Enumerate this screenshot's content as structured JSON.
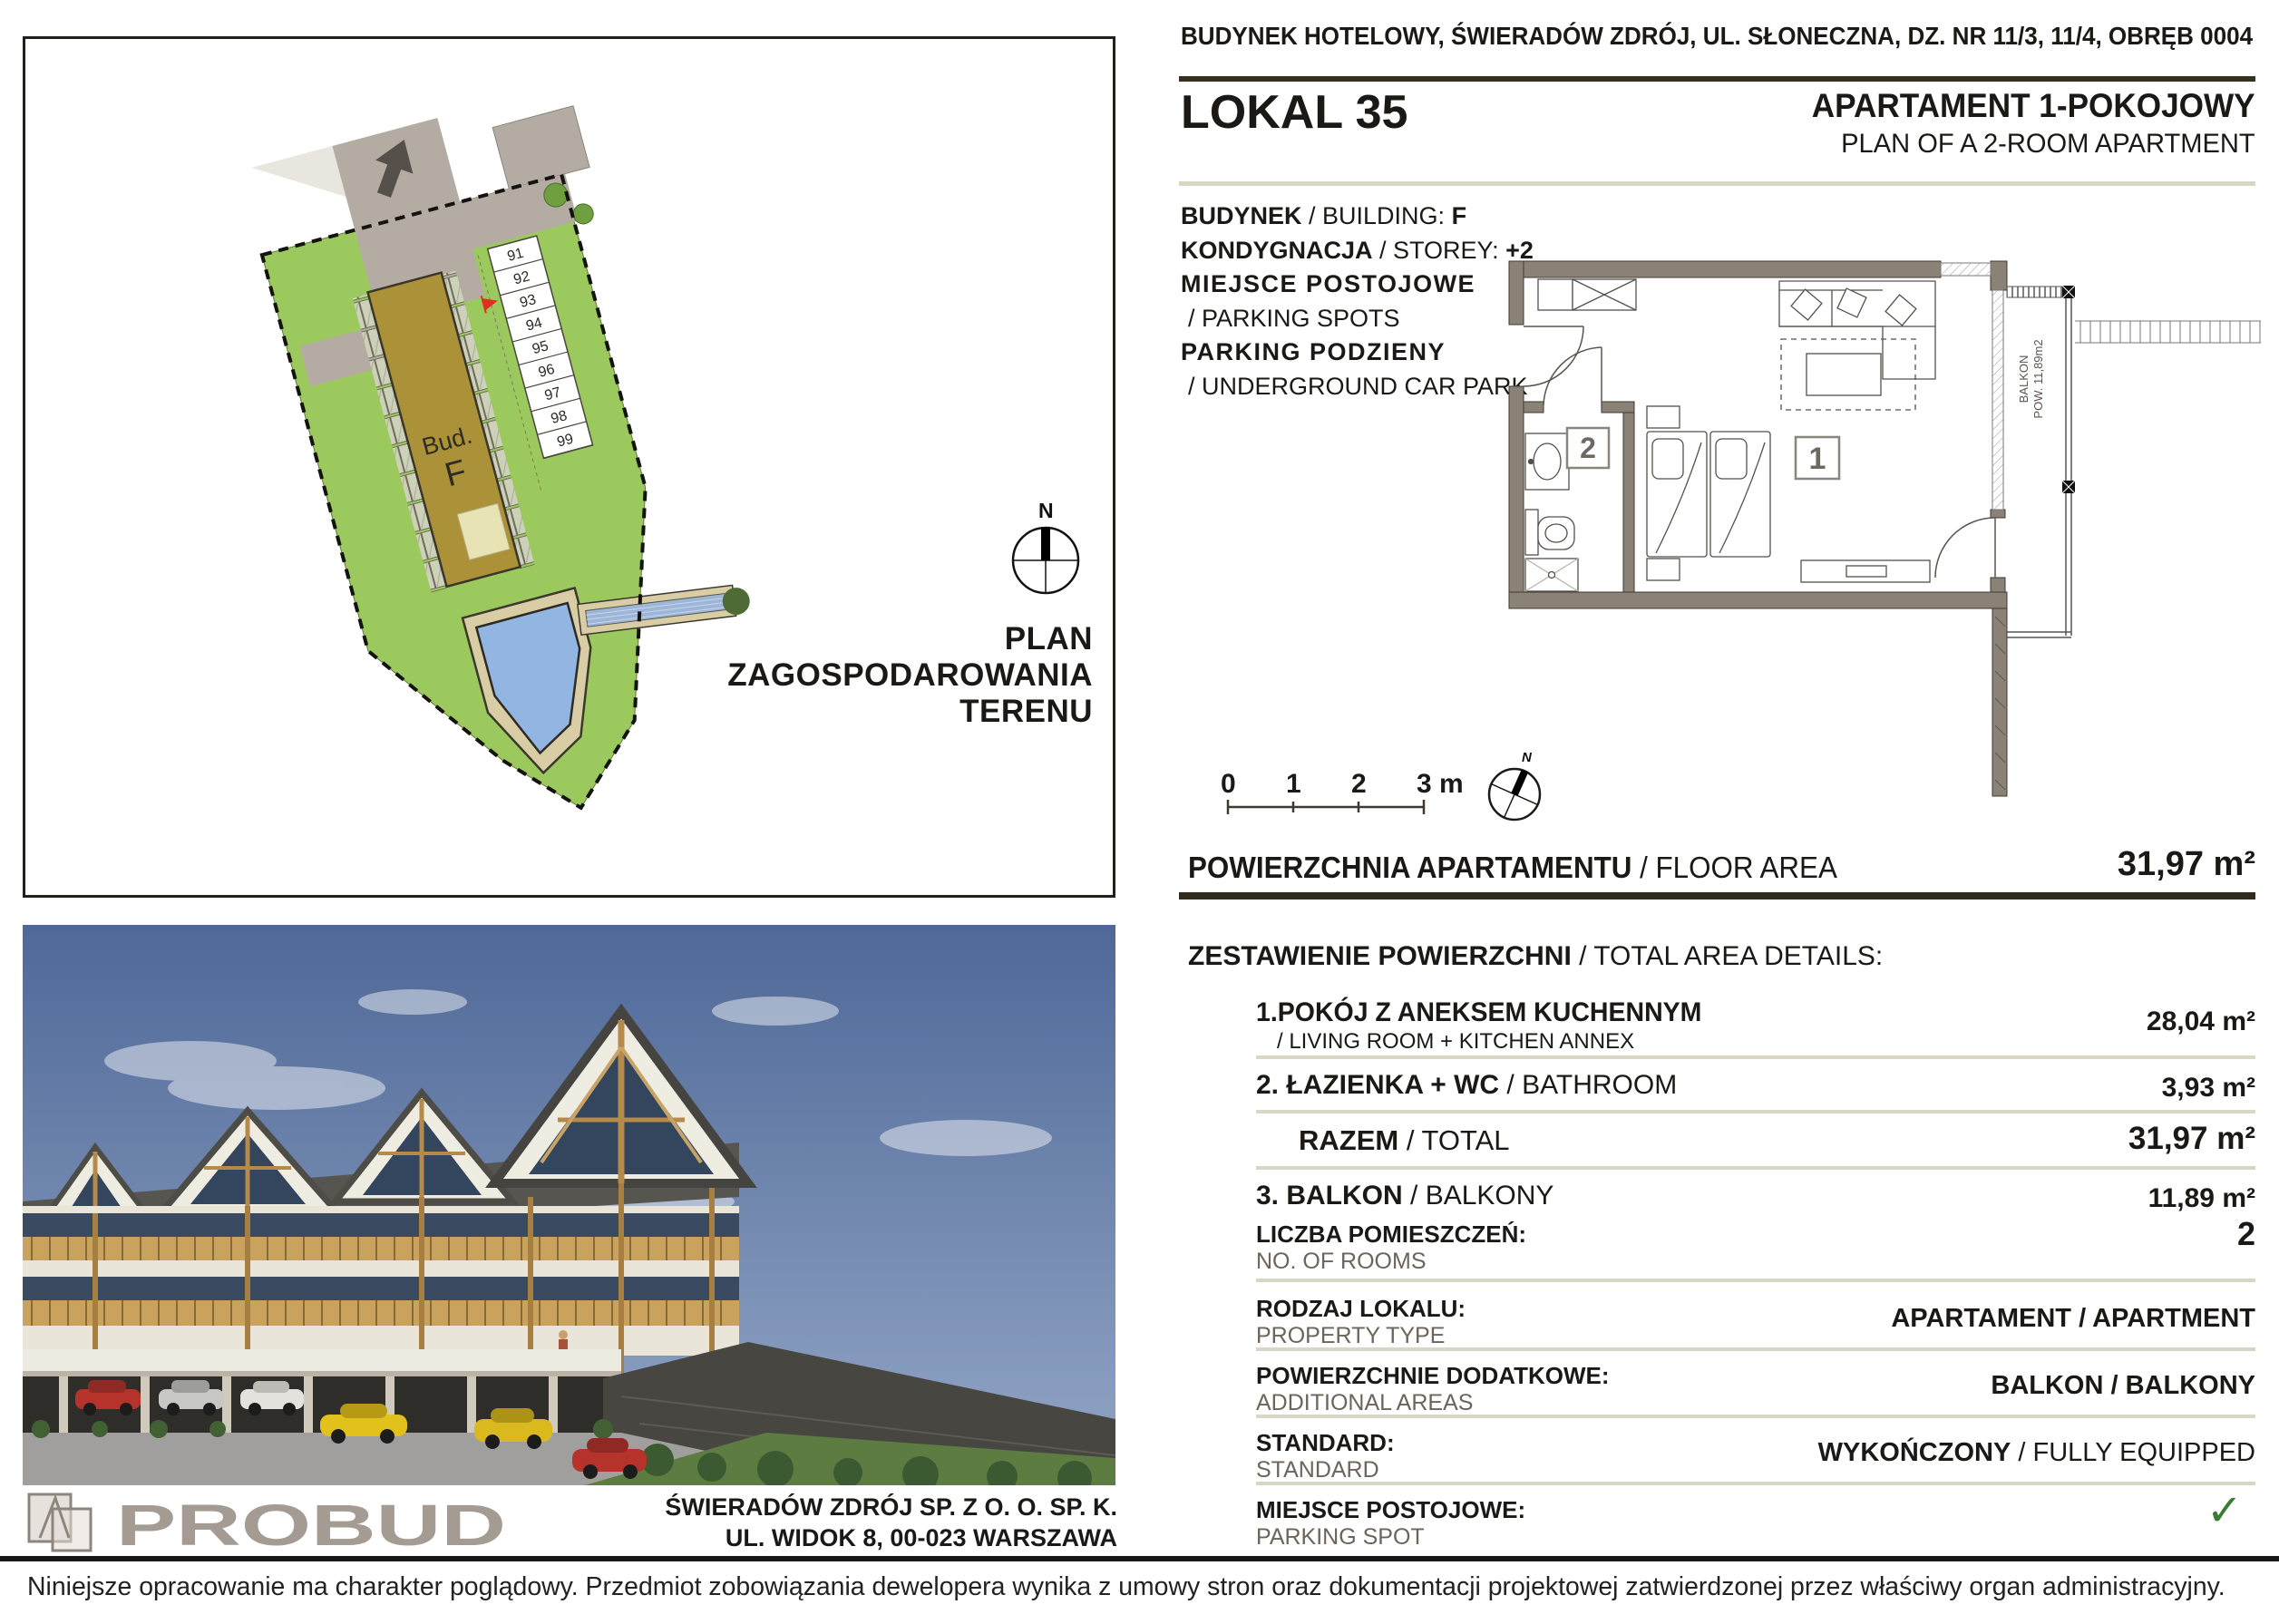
{
  "page": {
    "address_header": "BUDYNEK HOTELOWY, ŚWIERADÓW ZDRÓJ, UL. SŁONECZNA, DZ. NR 11/3, 11/4, OBRĘB 0004",
    "disclaimer": "Niniejsze opracowanie ma charakter poglądowy. Przedmiot zobowiązania dewelopera wynika z umowy stron oraz dokumentacji projektowej zatwierdzonej przez właściwy organ administracyjny."
  },
  "unit": {
    "lokal": "LOKAL 35",
    "type_pl": "APARTAMENT 1-POKOJOWY",
    "type_en": "PLAN OF A 2-ROOM APARTMENT",
    "building_label_pl": "BUDYNEK",
    "building_label_en": " / BUILDING: ",
    "building_value": "F",
    "storey_label_pl": "KONDYGNACJA",
    "storey_label_en": " / STOREY: ",
    "storey_value": "+2",
    "parking_pl": "MIEJSCE POSTOJOWE",
    "parking_en": "/ PARKING SPOTS",
    "garage_pl": "PARKING PODZIENY",
    "garage_en": "/ UNDERGROUND CAR PARK"
  },
  "site_plan": {
    "title_line1": "PLAN",
    "title_line2": "ZAGOSPODAROWANIA",
    "title_line3": "TERENU",
    "building_label_line1": "Bud.",
    "building_label_line2": "F",
    "compass_n": "N",
    "parking_numbers": [
      "91",
      "92",
      "93",
      "94",
      "95",
      "96",
      "97",
      "98",
      "99"
    ]
  },
  "floor_plan": {
    "room1": "1",
    "room2": "2",
    "balcony_line1": "BALKON",
    "balcony_line2": "POW. 11,89m2",
    "compass_n": "N",
    "scale_ticks": [
      "0",
      "1",
      "2",
      "3 m"
    ]
  },
  "area_summary": {
    "title_pl": "POWIERZCHNIA APARTAMENTU",
    "title_en": " / FLOOR AREA",
    "value": "31,97 m²",
    "details_title_pl": "ZESTAWIENIE POWIERZCHNI",
    "details_title_en": " / TOTAL AREA DETAILS:",
    "rows": [
      {
        "label_pl": "1.POKÓJ Z ANEKSEM KUCHENNYM",
        "label_en": "/ LIVING ROOM + KITCHEN ANNEX",
        "value": "28,04 m²"
      },
      {
        "label_pl": "2. ŁAZIENKA + WC",
        "label_en": " / BATHROOM",
        "value": "3,93 m²"
      },
      {
        "label_pl": "RAZEM",
        "label_en": " / TOTAL",
        "value": "31,97 m²"
      },
      {
        "label_pl": "3. BALKON",
        "label_en": " / BALKONY",
        "value": "11,89 m²"
      }
    ],
    "properties": [
      {
        "label_pl": "LICZBA POMIESZCZEŃ:",
        "label_en": "NO. OF ROOMS",
        "value": "2"
      },
      {
        "label_pl": "RODZAJ LOKALU:",
        "label_en": "PROPERTY TYPE",
        "value": "APARTAMENT / APARTMENT"
      },
      {
        "label_pl": "POWIERZCHNIE DODATKOWE:",
        "label_en": "ADDITIONAL AREAS",
        "value": "BALKON / BALKONY"
      },
      {
        "label_pl": "STANDARD:",
        "label_en": "STANDARD",
        "value_pl": "WYKOŃCZONY",
        "value_en": " / FULLY EQUIPPED"
      },
      {
        "label_pl": "MIEJSCE POSTOJOWE:",
        "label_en": "PARKING SPOT",
        "value": "✓"
      }
    ]
  },
  "footer": {
    "logo_text": "PROBUD",
    "company_line1": "ŚWIERADÓW ZDRÓJ SP. Z O. O. SP. K.",
    "company_line2": "UL. WIDOK 8, 00-023 WARSZAWA"
  },
  "colors": {
    "dark_rule": "#35301f",
    "light_rule": "#d9d6c6",
    "check_green": "#3c7a35",
    "grass": "#9cc95d",
    "building_olive": "#ab9138",
    "pond_blue": "#93b5e2",
    "wall_taupe": "#8b8277",
    "logo_gray": "#a49c92"
  }
}
